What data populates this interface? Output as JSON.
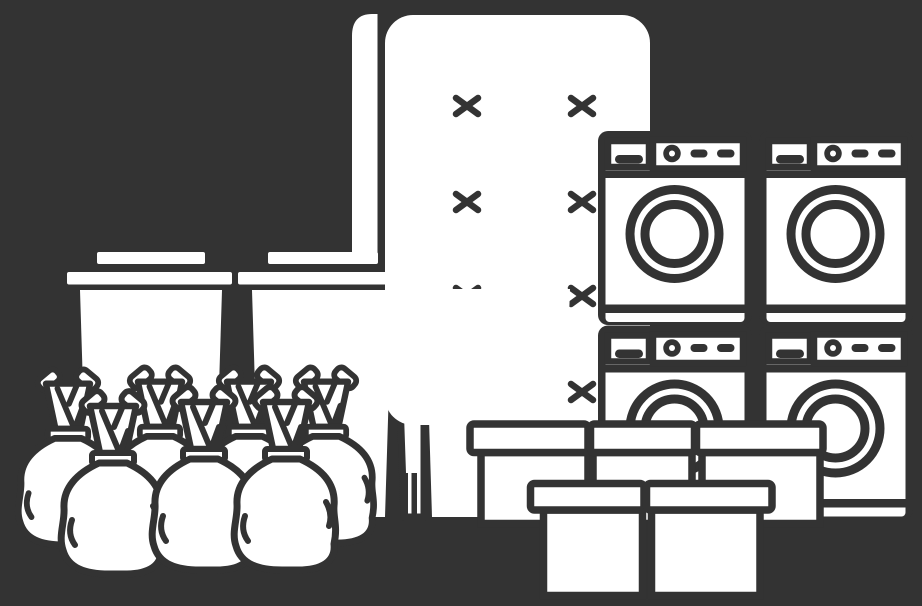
{
  "scene": {
    "description": "Monochrome line-art illustration of a household rubbish pile on a dark background: two mattresses leaning upright, three wheelie bins, four washing machines stacked two by two, five cardboard boxes and seven tied rubbish bags",
    "colors": {
      "background": "#333333",
      "artwork_fill": "#ffffff",
      "artwork_line": "#333333"
    },
    "inventory": [
      {
        "item": "mattress",
        "count": 2
      },
      {
        "item": "wheelie-bin",
        "count": 3
      },
      {
        "item": "washing-machine",
        "count": 4
      },
      {
        "item": "cardboard-box",
        "count": 5
      },
      {
        "item": "rubbish-bag",
        "count": 7
      }
    ]
  }
}
